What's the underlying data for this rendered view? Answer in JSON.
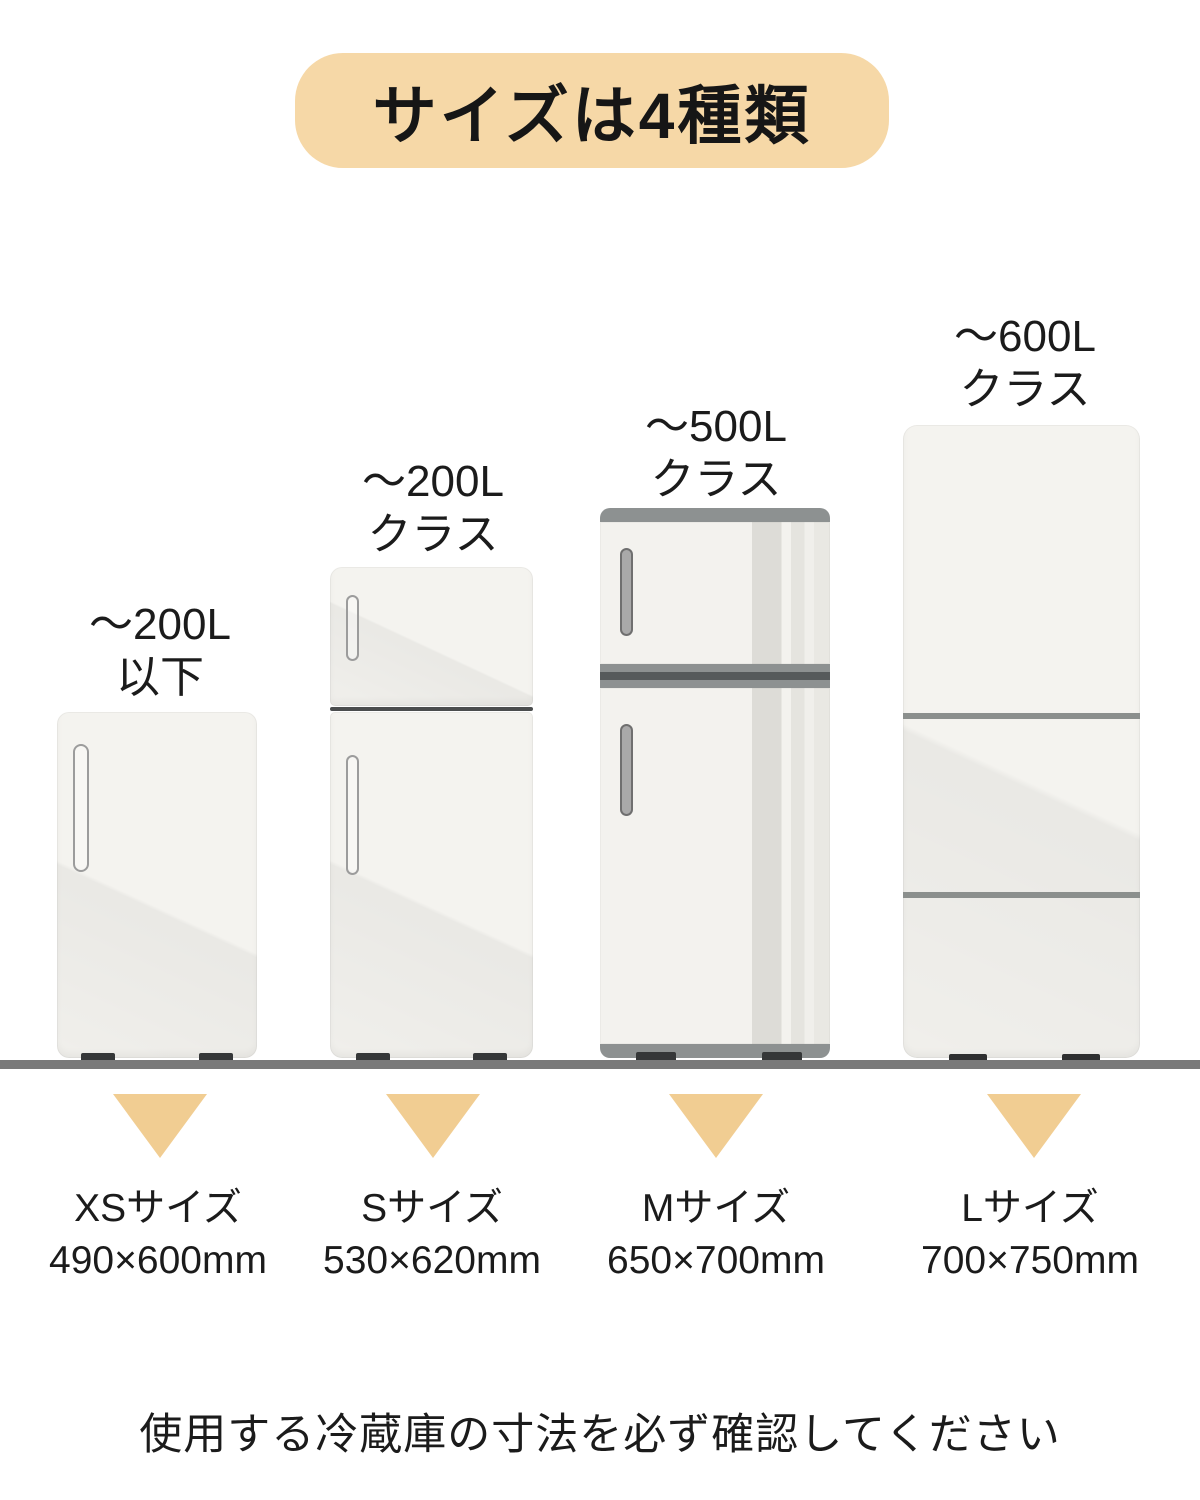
{
  "title": "サイズは4種類",
  "caption": "使用する冷蔵庫の寸法を必ず確認してください",
  "colors": {
    "badge": "#f6d8a7",
    "triangle": "#f1cd92",
    "floor": "#7a7a7a",
    "fridge_body": "#f4f3ef",
    "text": "#1b1b1b"
  },
  "sizes": [
    {
      "capacity_line1": "～200L",
      "capacity_line2": "以下",
      "size_name": "XSサイズ",
      "dimensions": "490×600mm"
    },
    {
      "capacity_line1": "～200L",
      "capacity_line2": "クラス",
      "size_name": "Sサイズ",
      "dimensions": "530×620mm"
    },
    {
      "capacity_line1": "～500L",
      "capacity_line2": "クラス",
      "size_name": "Mサイズ",
      "dimensions": "650×700mm"
    },
    {
      "capacity_line1": "～600L",
      "capacity_line2": "クラス",
      "size_name": "Lサイズ",
      "dimensions": "700×750mm"
    }
  ]
}
